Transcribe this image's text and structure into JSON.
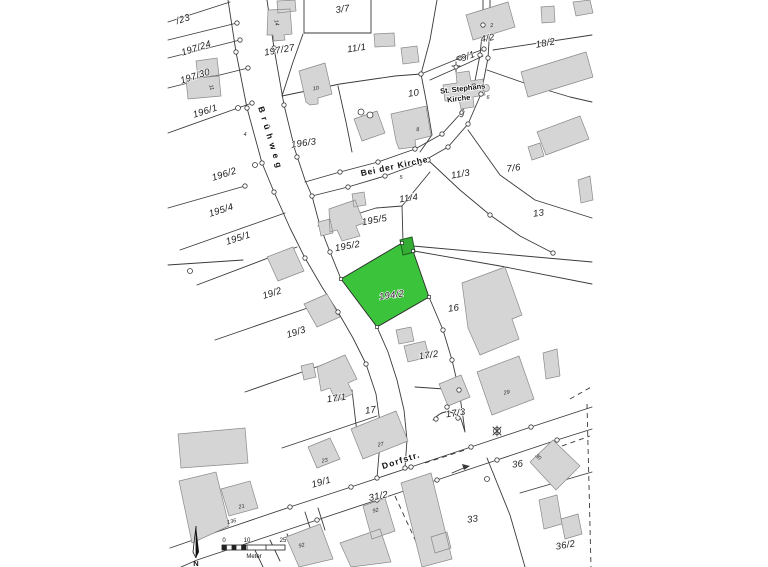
{
  "map": {
    "kind": "cadastral-parcel-map",
    "highlighted_parcel": {
      "id": "194/2",
      "fill": "#3cc33c",
      "outbuilding_fill": "#35ad35"
    },
    "colors": {
      "background": "#ffffff",
      "building": "#d5d5d5",
      "boundary_line": "#3a3a3a",
      "label": "#1b1b1b"
    },
    "street_names": [
      {
        "text": "Brühweg",
        "x": 268,
        "y": 140,
        "rot": 73,
        "ls": 4.5
      },
      {
        "text": "Bei der Kirche",
        "x": 395,
        "y": 169,
        "rot": -12,
        "ls": 0.8
      },
      {
        "text": "Dorfstr.",
        "x": 402,
        "y": 463,
        "rot": -18,
        "ls": 1.2
      }
    ],
    "church_labels": [
      {
        "text": "St. Stephans",
        "x": 463,
        "y": 91,
        "rot": -7
      },
      {
        "text": "Kirche",
        "x": 459,
        "y": 101,
        "rot": -7
      }
    ],
    "parcel_labels": [
      {
        "text": "/23",
        "x": 184,
        "y": 22,
        "rot": -18
      },
      {
        "text": "197/24",
        "x": 197,
        "y": 51,
        "rot": -18
      },
      {
        "text": "197/30",
        "x": 196,
        "y": 79,
        "rot": -18
      },
      {
        "text": "196/1",
        "x": 206,
        "y": 114,
        "rot": -18
      },
      {
        "text": "197/27",
        "x": 280,
        "y": 53,
        "rot": -10
      },
      {
        "text": "3/7",
        "x": 343,
        "y": 12,
        "rot": -8
      },
      {
        "text": "11/1",
        "x": 357,
        "y": 51,
        "rot": -8
      },
      {
        "text": "4/2",
        "x": 488,
        "y": 41,
        "rot": -10
      },
      {
        "text": "18/2",
        "x": 546,
        "y": 46,
        "rot": -10
      },
      {
        "text": "9/1",
        "x": 469,
        "y": 59,
        "rot": -20
      },
      {
        "text": "10",
        "x": 414,
        "y": 96,
        "rot": -8
      },
      {
        "text": "9",
        "x": 462,
        "y": 117,
        "rot": -8
      },
      {
        "text": "196/3",
        "x": 304,
        "y": 146,
        "rot": -8
      },
      {
        "text": "11/3",
        "x": 461,
        "y": 177,
        "rot": -10
      },
      {
        "text": "7/6",
        "x": 514,
        "y": 171,
        "rot": -8
      },
      {
        "text": "11/4",
        "x": 409,
        "y": 201,
        "rot": -8
      },
      {
        "text": "195/5",
        "x": 375,
        "y": 223,
        "rot": -10
      },
      {
        "text": "13",
        "x": 539,
        "y": 216,
        "rot": -8
      },
      {
        "text": "196/2",
        "x": 225,
        "y": 177,
        "rot": -18
      },
      {
        "text": "195/4",
        "x": 222,
        "y": 213,
        "rot": -18
      },
      {
        "text": "195/1",
        "x": 239,
        "y": 241,
        "rot": -18
      },
      {
        "text": "195/2",
        "x": 348,
        "y": 249,
        "rot": -10
      },
      {
        "text": "194/2",
        "x": 392,
        "y": 298,
        "rot": -8
      },
      {
        "text": "16",
        "x": 454,
        "y": 311,
        "rot": -8
      },
      {
        "text": "19/2",
        "x": 273,
        "y": 296,
        "rot": -18
      },
      {
        "text": "19/3",
        "x": 297,
        "y": 335,
        "rot": -18
      },
      {
        "text": "17/2",
        "x": 429,
        "y": 358,
        "rot": -8
      },
      {
        "text": "17/1",
        "x": 337,
        "y": 401,
        "rot": -8
      },
      {
        "text": "17",
        "x": 371,
        "y": 413,
        "rot": -8
      },
      {
        "text": "17/3",
        "x": 456,
        "y": 416,
        "rot": -8
      },
      {
        "text": "19/1",
        "x": 322,
        "y": 485,
        "rot": -16
      },
      {
        "text": "31/2",
        "x": 379,
        "y": 499,
        "rot": -12
      },
      {
        "text": "36",
        "x": 518,
        "y": 467,
        "rot": -8
      },
      {
        "text": "33",
        "x": 473,
        "y": 522,
        "rot": -8
      },
      {
        "text": "36/2",
        "x": 566,
        "y": 548,
        "rot": -10
      }
    ],
    "house_numbers": [
      {
        "text": "14",
        "x": 275,
        "y": 23,
        "rot": 78
      },
      {
        "text": "2",
        "x": 492,
        "y": 27,
        "rot": -10
      },
      {
        "text": "11",
        "x": 210,
        "y": 88,
        "rot": 72
      },
      {
        "text": "10",
        "x": 316,
        "y": 90,
        "rot": -8
      },
      {
        "text": "8",
        "x": 418,
        "y": 131,
        "rot": -8
      },
      {
        "text": "4",
        "x": 245,
        "y": 136,
        "rot": 0
      },
      {
        "text": "65",
        "x": 459,
        "y": 60,
        "rot": 0
      },
      {
        "text": "6",
        "x": 488,
        "y": 99,
        "rot": 0
      },
      {
        "text": "5",
        "x": 401,
        "y": 179,
        "rot": 0
      },
      {
        "text": "27",
        "x": 381,
        "y": 446,
        "rot": -12
      },
      {
        "text": "23",
        "x": 325,
        "y": 462,
        "rot": -12
      },
      {
        "text": "29",
        "x": 507,
        "y": 394,
        "rot": -12
      },
      {
        "text": "21",
        "x": 242,
        "y": 508,
        "rot": -14
      },
      {
        "text": "136",
        "x": 232,
        "y": 523,
        "rot": -12
      },
      {
        "text": "92",
        "x": 376,
        "y": 512,
        "rot": -14
      },
      {
        "text": "92",
        "x": 302,
        "y": 547,
        "rot": -14
      },
      {
        "text": "30",
        "x": 537,
        "y": 458,
        "rot": 45
      }
    ],
    "scale_bar": {
      "min": "0",
      "mid": "10",
      "max": "25",
      "unit": "Meter"
    },
    "scale_labels": [
      {
        "text": "0",
        "x": 224,
        "y": 542,
        "rot": 0
      },
      {
        "text": "10",
        "x": 247,
        "y": 542,
        "rot": 0
      },
      {
        "text": "25",
        "x": 283,
        "y": 542,
        "rot": 0
      },
      {
        "text": "Meter",
        "x": 254,
        "y": 558,
        "rot": 0
      }
    ],
    "north_labels": [
      {
        "text": "N",
        "x": 196,
        "y": 566,
        "rot": 0
      }
    ]
  }
}
